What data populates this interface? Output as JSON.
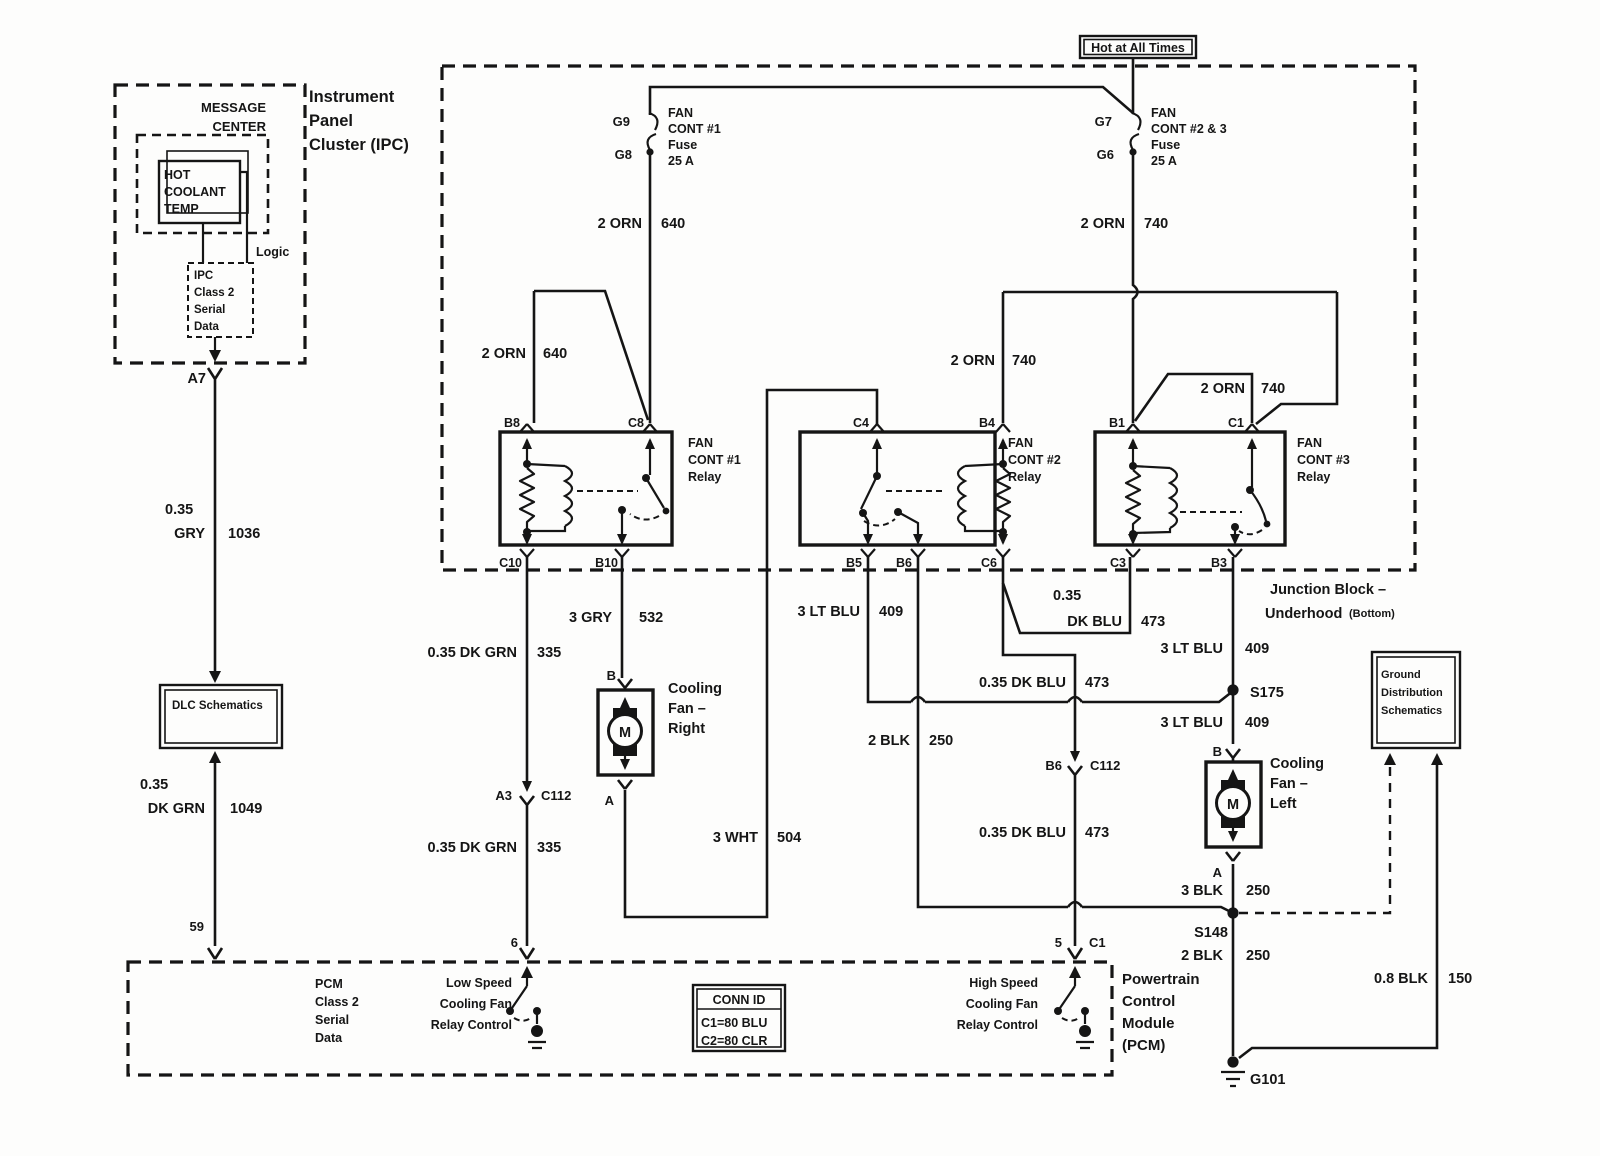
{
  "diagram": {
    "ipc": {
      "title1": "Instrument",
      "title2": "Panel",
      "title3": "Cluster (IPC)",
      "message1": "MESSAGE",
      "message2": "CENTER",
      "hot1": "HOT",
      "hot2": "COOLANT",
      "hot3": "TEMP",
      "logic": "Logic",
      "serial1": "IPC",
      "serial2": "Class 2",
      "serial3": "Serial",
      "serial4": "Data",
      "pin": "A7"
    },
    "power": {
      "hot_at_all_times": "Hot at All Times"
    },
    "fuse1": {
      "pin_top": "G9",
      "pin_bottom": "G8",
      "name1": "FAN",
      "name2": "CONT #1",
      "name3": "Fuse",
      "name4": "25 A"
    },
    "fuse2": {
      "pin_top": "G7",
      "pin_bottom": "G6",
      "name1": "FAN",
      "name2": "CONT #2 & 3",
      "name3": "Fuse",
      "name4": "25 A"
    },
    "junction_block": {
      "label1": "Junction Block –",
      "label2": "Underhood",
      "label2b": "(Bottom)"
    },
    "relay1": {
      "name1": "FAN",
      "name2": "CONT #1",
      "name3": "Relay",
      "pin_tl": "B8",
      "pin_tr": "C8",
      "pin_bl": "C10",
      "pin_br": "B10"
    },
    "relay2": {
      "name1": "FAN",
      "name2": "CONT #2",
      "name3": "Relay",
      "pin_tl": "C4",
      "pin_tr": "B4",
      "pin_b1": "B5",
      "pin_b2": "B6",
      "pin_br": "C6"
    },
    "relay3": {
      "name1": "FAN",
      "name2": "CONT #3",
      "name3": "Relay",
      "pin_tl": "B1",
      "pin_tr": "C1",
      "pin_bl": "C3",
      "pin_br": "B3"
    },
    "fan_right": {
      "name1": "Cooling",
      "name2": "Fan –",
      "name3": "Right",
      "motor": "M",
      "pin_top": "B",
      "pin_bottom": "A"
    },
    "fan_left": {
      "name1": "Cooling",
      "name2": "Fan –",
      "name3": "Left",
      "motor": "M",
      "pin_top": "B",
      "pin_bottom": "A"
    },
    "dlc": {
      "label": "DLC Schematics"
    },
    "ground_dist": {
      "line1": "Ground",
      "line2": "Distribution",
      "line3": "Schematics"
    },
    "pcm": {
      "pin_59": "59",
      "pin_6": "6",
      "pin_5": "5",
      "pin_5_conn": "C1",
      "serial1": "PCM",
      "serial2": "Class 2",
      "serial3": "Serial",
      "serial4": "Data",
      "low1": "Low Speed",
      "low2": "Cooling Fan",
      "low3": "Relay Control",
      "high1": "High Speed",
      "high2": "Cooling Fan",
      "high3": "Relay Control",
      "name1": "Powertrain",
      "name2": "Control",
      "name3": "Module",
      "name4": "(PCM)"
    },
    "conn_id": {
      "title": "CONN ID",
      "row1": "C1=80 BLU",
      "row2": "C2=80 CLR"
    },
    "splices": {
      "s175": "S175",
      "s148": "S148",
      "g101": "G101"
    },
    "connectors": {
      "a3": "A3",
      "a3_conn": "C112",
      "b6": "B6",
      "b6_conn": "C112"
    },
    "wires": {
      "orn640_fuse": {
        "l": "2 ORN",
        "r": "640"
      },
      "orn640_b8": {
        "l": "2 ORN",
        "r": "640"
      },
      "orn740_fuse": {
        "l": "2 ORN",
        "r": "740"
      },
      "orn740_b4": {
        "l": "2 ORN",
        "r": "740"
      },
      "orn740_c1": {
        "l": "2 ORN",
        "r": "740"
      },
      "gry532": {
        "l": "3 GRY",
        "r": "532"
      },
      "dkgrn335_a": {
        "l": "0.35 DK GRN",
        "r": "335"
      },
      "dkgrn335_b": {
        "l": "0.35 DK GRN",
        "r": "335"
      },
      "ltblu409_b5": {
        "l": "3 LT BLU",
        "r": "409"
      },
      "ltblu409_up": {
        "l": "3 LT BLU",
        "r": "409"
      },
      "ltblu409_dn": {
        "l": "3 LT BLU",
        "r": "409"
      },
      "dkblu473_jb": {
        "l1": "0.35",
        "l2": "DK BLU",
        "r": "473"
      },
      "dkblu473_mid": {
        "l": "0.35 DK BLU",
        "r": "473"
      },
      "dkblu473_low": {
        "l": "0.35 DK BLU",
        "r": "473"
      },
      "wht504": {
        "l": "3 WHT",
        "r": "504"
      },
      "blk250_relay": {
        "l": "2 BLK",
        "r": "250"
      },
      "blk250_fan": {
        "l": "3 BLK",
        "r": "250"
      },
      "blk250_gnd": {
        "l": "2 BLK",
        "r": "250"
      },
      "blk150": {
        "l": "0.8 BLK",
        "r": "150"
      },
      "gry1036": {
        "l1": "0.35",
        "l2": "GRY",
        "r": "1036"
      },
      "dkgrn1049": {
        "l1": "0.35",
        "l2": "DK GRN",
        "r": "1049"
      }
    }
  }
}
